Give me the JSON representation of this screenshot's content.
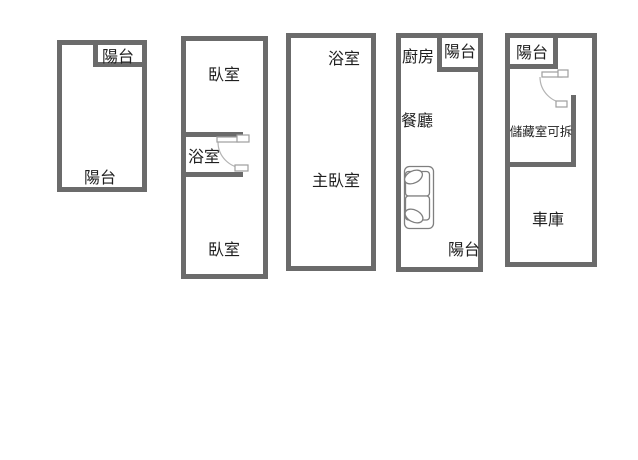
{
  "palette": {
    "background": "#ffffff",
    "wall": "#6b6b6b",
    "text": "#1f1f1f",
    "door_line": "#9e9e9e",
    "door_arc": "#b3b3b3",
    "sofa_line": "#7f7f7f"
  },
  "units": [
    {
      "labels": [
        {
          "room": "balcony-top",
          "text": "陽台"
        },
        {
          "room": "balcony-main",
          "text": "陽台"
        }
      ]
    },
    {
      "labels": [
        {
          "room": "bedroom-top",
          "text": "臥室"
        },
        {
          "room": "bathroom",
          "text": "浴室"
        },
        {
          "room": "bedroom-bottom",
          "text": "臥室"
        }
      ]
    },
    {
      "labels": [
        {
          "room": "bathroom",
          "text": "浴室"
        },
        {
          "room": "master-bedroom",
          "text": "主臥室"
        }
      ]
    },
    {
      "labels": [
        {
          "room": "kitchen",
          "text": "廚房"
        },
        {
          "room": "balcony-top",
          "text": "陽台"
        },
        {
          "room": "dining-room",
          "text": "餐廳"
        },
        {
          "room": "balcony-bottom",
          "text": "陽台"
        }
      ]
    },
    {
      "labels": [
        {
          "room": "balcony",
          "text": "陽台"
        },
        {
          "room": "storage-removable",
          "text": "儲藏室可拆"
        },
        {
          "room": "garage",
          "text": "車庫"
        }
      ]
    }
  ],
  "icons": {
    "bathroom_door": "door-swing-arc",
    "storage_door": "door-swing-arc",
    "sofa": "sofa-top-view"
  }
}
